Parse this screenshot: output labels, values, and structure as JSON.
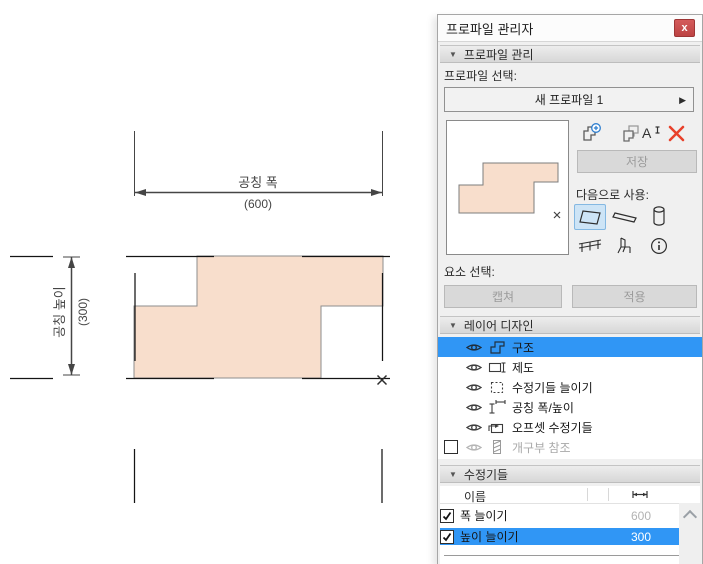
{
  "window": {
    "title": "프로파일 관리자",
    "close_glyph": "x"
  },
  "glyphs": {
    "section_collapse": "▼",
    "combo_next": "▶"
  },
  "canvas": {
    "width_dim": {
      "label": "공칭 폭",
      "value": "(600)"
    },
    "height_dim": {
      "label": "공칭 높이",
      "value": "(300)"
    }
  },
  "panel": {
    "section_profile_manage": "프로파일 관리",
    "profile_select_label": "프로파일 선택:",
    "profile_name": "새 프로파일 1",
    "save_label": "저장",
    "use_as_label": "다음으로 사용:",
    "element_select_label": "요소 선택:",
    "capture_label": "캡쳐",
    "apply_label": "적용",
    "section_layer_design": "레이어 디자인",
    "layers": [
      {
        "label": "구조",
        "selected": true
      },
      {
        "label": "제도"
      },
      {
        "label": "수정기들 늘이기"
      },
      {
        "label": "공칭 폭/높이"
      },
      {
        "label": "오프셋 수정기들"
      },
      {
        "label": "개구부 참조",
        "disabled": true,
        "checked": false
      }
    ],
    "section_modifiers": "수정기들",
    "modifier_table": {
      "name_header": "이름",
      "rows": [
        {
          "checked": true,
          "name": "폭 늘이기",
          "value": "600",
          "selected": false
        },
        {
          "checked": true,
          "name": "높이 늘이기",
          "value": "300",
          "selected": true
        }
      ]
    }
  },
  "colors": {
    "selection_blue": "#3096f5",
    "profile_fill": "#f8decc",
    "profile_outline": "#8e8e8e",
    "dimension_gray": "#454545",
    "delete_red": "#e8402a",
    "close_button_red": "#c94b4b",
    "tool_selected_bg": "#cde4f6",
    "panel_bg": "#f0f0f0"
  }
}
